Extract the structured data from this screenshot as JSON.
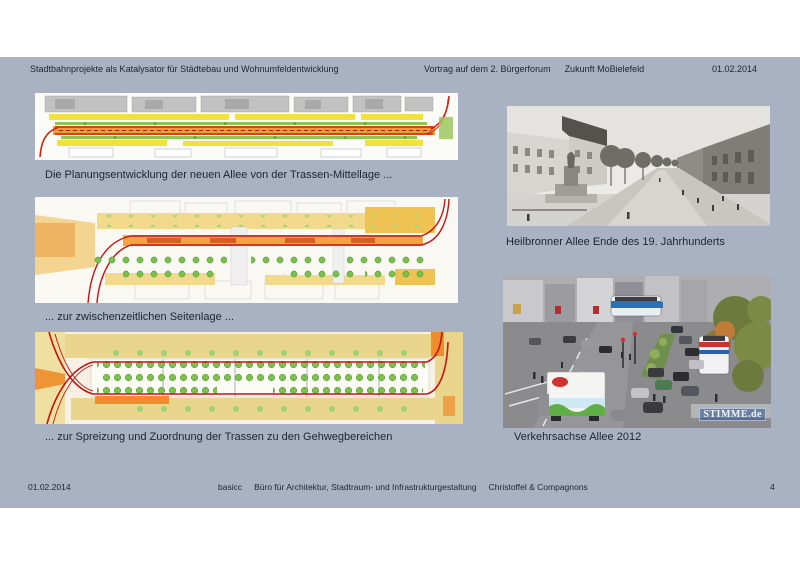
{
  "colors": {
    "page_bg": "#ffffff",
    "slide_bg": "#a9b2c3",
    "text": "#1c2433",
    "map_red": "#c81414",
    "map_orange": "#f09a38",
    "map_yellow": "#f2e13c",
    "map_tan": "#ead88f",
    "map_green": "#7bc24e"
  },
  "header": {
    "title": "Stadtbahnprojekte als Katalysator für Städtebau und Wohnumfeldentwicklung",
    "event": "Vortrag auf dem 2. Bürgerforum",
    "event_name": "Zukunft MoBielefeld",
    "date": "01.02.2014"
  },
  "plans": [
    {
      "caption": "Die Planungsentwicklung der neuen Allee von der Trassen-Mittellage ..."
    },
    {
      "caption": "... zur zwischenzeitlichen Seitenlage ..."
    },
    {
      "caption": "... zur Spreizung und Zuordnung der Trassen zu den Gehwegbereichen"
    }
  ],
  "photos": [
    {
      "caption": "Heilbronner Allee Ende des 19. Jahrhunderts"
    },
    {
      "caption": "Verkehrsachse Allee 2012",
      "watermark": "STIMME.de"
    }
  ],
  "footer": {
    "date": "01.02.2014",
    "credit_firm": "basicc",
    "credit_desc": "Büro für Architektur, Stadtraum- und Infrastrukturgestaltung",
    "credit_names": "Christoffel & Compagnons",
    "page_number": "4"
  }
}
